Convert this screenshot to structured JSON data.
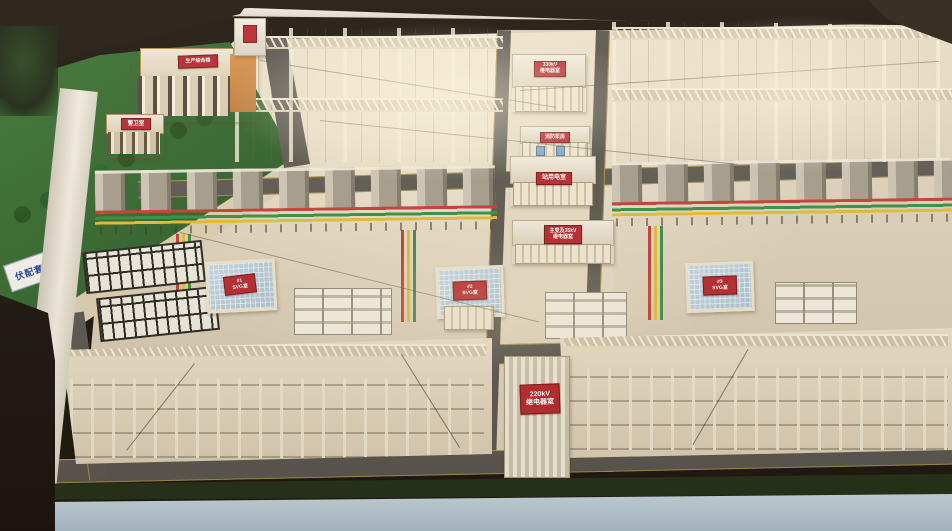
{
  "scene_title": "substation scale model photo",
  "labels": {
    "title_plate": "伏配套工",
    "production_building": "生产综合楼",
    "guard_room": "警卫室",
    "top_relay": {
      "line1": "330kV",
      "line2": "继电器室"
    },
    "fire_pump": "消防泵房",
    "station_power": "站用电室",
    "tx35": {
      "line1": "主变及35kV",
      "line2": "继电器室"
    },
    "svg1": {
      "line1": "#1",
      "line2": "SVG室"
    },
    "svg2": {
      "line1": "#2",
      "line2": "SVG室"
    },
    "svg3": {
      "line1": "#3",
      "line2": "SVG室"
    },
    "relay220": {
      "line1": "220kV",
      "line2": "继电器室"
    }
  },
  "colors": {
    "sign_red": "#b5232b",
    "sign_text": "#ffffff",
    "ground_beige": "#ddd2bd",
    "road_gray": "#57554f",
    "road_line_yellow": "#d6b24a",
    "grass_green": "#2c612a",
    "roof_blue": "#b9d4e4",
    "orange_building": "#cf8a44",
    "busbar_red": "#c23a34",
    "busbar_green": "#2f8f3f",
    "busbar_yellow": "#e3bc2e",
    "table_frame_white": "#f2eee3",
    "table_front_blue": "#b6c9d6"
  }
}
